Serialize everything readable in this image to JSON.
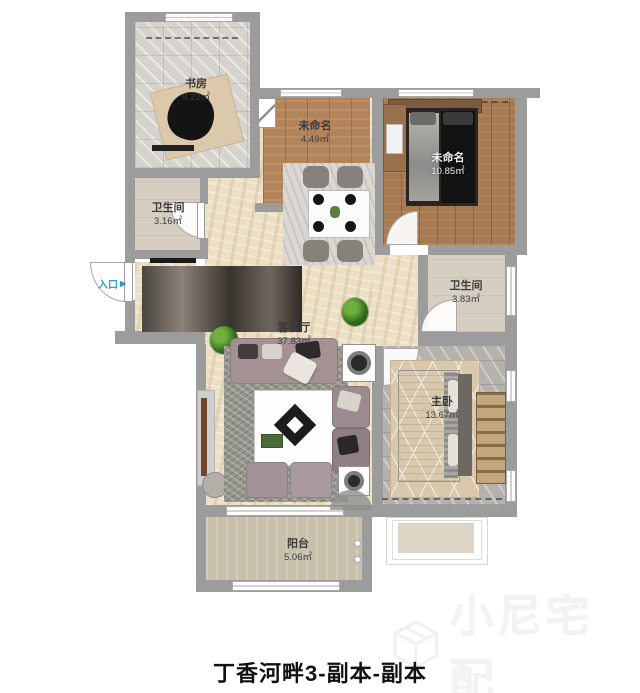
{
  "title": "丁香河畔3-副本-副本",
  "watermark": {
    "brand": "小尼宅配",
    "logo_icon": "cube-logo-icon"
  },
  "entry": {
    "label": "入口",
    "arrow": "▶"
  },
  "rooms": {
    "study": {
      "name": "书房",
      "area": "9.22㎡"
    },
    "kitchen": {
      "name": "未命名",
      "area": "4.49㎡"
    },
    "bedroom2": {
      "name": "未命名",
      "area": "10.85㎡"
    },
    "bath1": {
      "name": "卫生间",
      "area": "3.16㎡"
    },
    "bath2": {
      "name": "卫生间",
      "area": "3.83㎡"
    },
    "living": {
      "name": "客餐厅",
      "area": "37.83㎡"
    },
    "master": {
      "name": "主卧",
      "area": "13.67㎡"
    },
    "balcony": {
      "name": "阳台",
      "area": "5.06㎡"
    }
  },
  "colors": {
    "wall": "#9c9c9c",
    "entry_blue": "#2a9bd6",
    "living_floor": "#ecdfc3",
    "wood_floor": "#b3835a",
    "watermark_gray": "#f3f3f3"
  }
}
